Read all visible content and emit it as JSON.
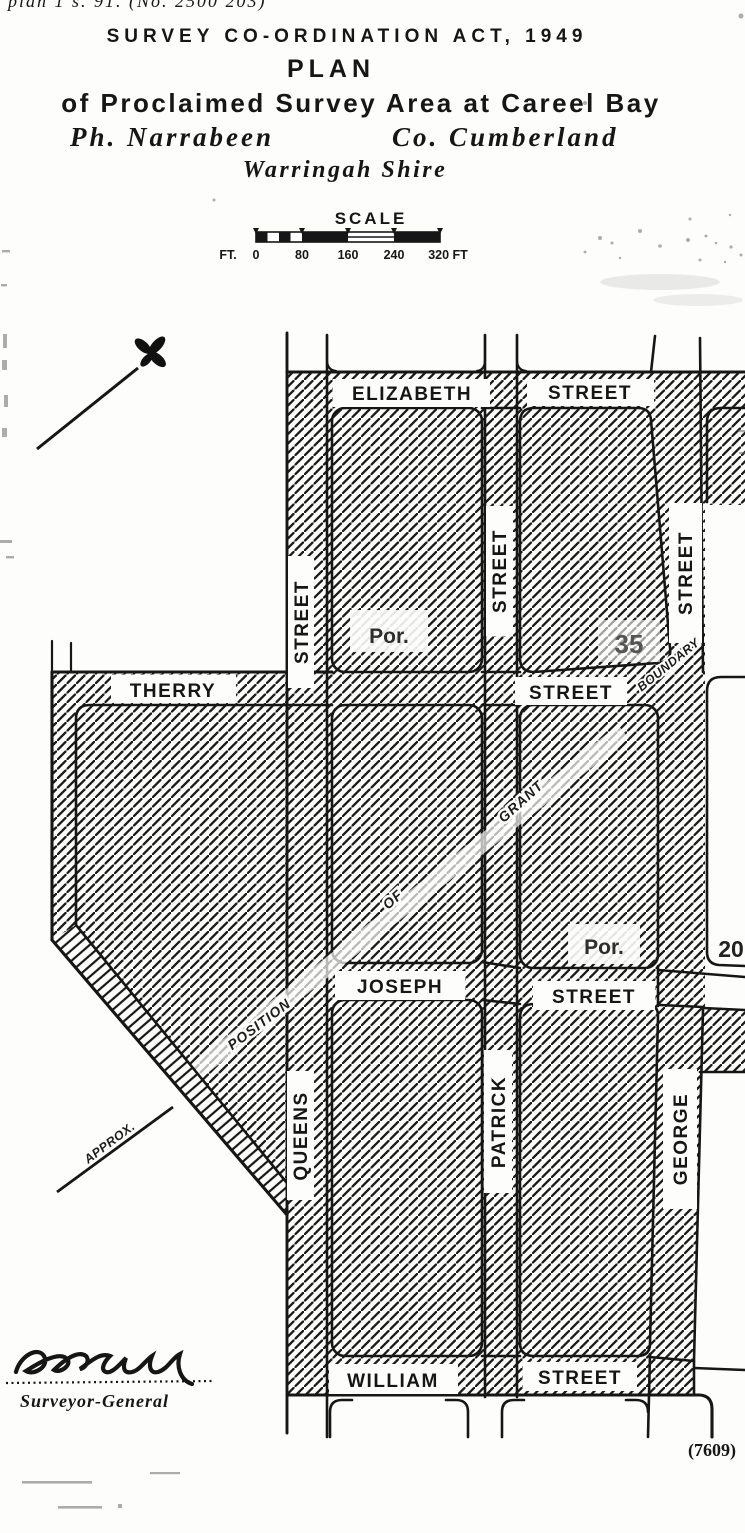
{
  "document": {
    "file_note": "plan 1 s. 91. (No. 2500 203)",
    "act_title": "SURVEY CO-ORDINATION ACT, 1949",
    "plan_heading": "PLAN",
    "subtitle": "of Proclaimed Survey Area at Careel Bay",
    "parish": "Ph. Narrabeen",
    "county": "Co. Cumberland",
    "shire": "Warringah Shire",
    "signature_title": "Surveyor-General",
    "plate_number": "(7609)"
  },
  "scale": {
    "heading": "SCALE",
    "unit_prefix": "FT.",
    "ticks": [
      "0",
      "80",
      "160",
      "240",
      "320 FT"
    ]
  },
  "map": {
    "streets": {
      "elizabeth": "ELIZABETH",
      "elizabeth_suffix": "STREET",
      "therry": "THERRY",
      "therry_suffix": "STREET",
      "joseph": "JOSEPH",
      "joseph_suffix": "STREET",
      "william": "WILLIAM",
      "william_suffix": "STREET",
      "queens": "QUEENS",
      "queens_suffix": "STREET",
      "patrick": "PATRICK",
      "patrick_suffix": "STREET",
      "george": "GEORGE",
      "george_suffix": "STREET"
    },
    "portions": {
      "portion_a_label": "Por.",
      "portion_a_number": "35",
      "portion_b_label": "Por.",
      "portion_b_number": "20"
    },
    "grant_annotation": {
      "approx": "APPROX.",
      "position": "POSITION",
      "of": "OF",
      "grant": "GRANT",
      "boundary": "BOUNDARY"
    }
  },
  "colors": {
    "ink": "#1a1a1a",
    "paper": "#fdfdfb"
  }
}
